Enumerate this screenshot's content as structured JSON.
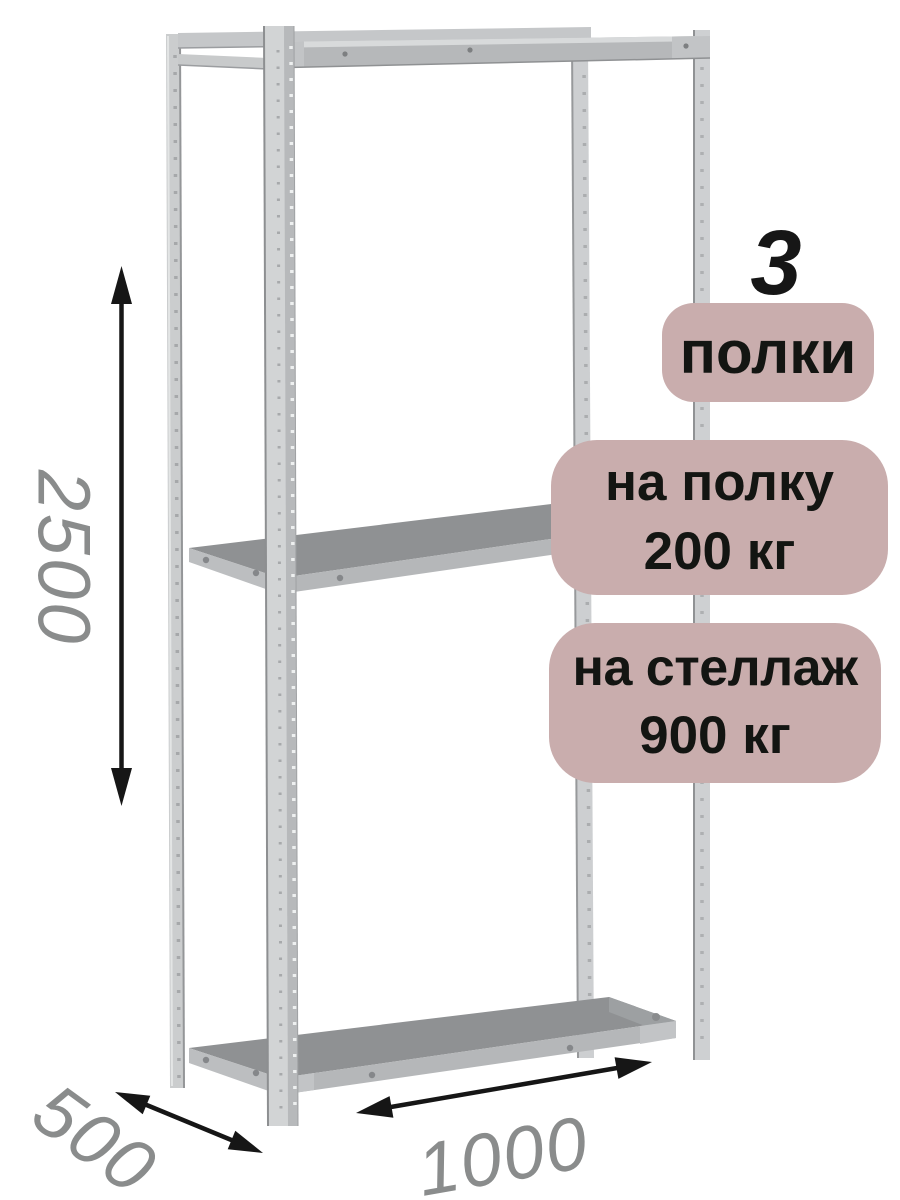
{
  "illustration": {
    "subject": "metal-shelving-rack",
    "shelves_shown": 3
  },
  "badges": {
    "shelves_count": "3",
    "shelves_label": "полки",
    "per_shelf_line1": "на полку",
    "per_shelf_line2": "200 кг",
    "per_rack_line1": "на стеллаж",
    "per_rack_line2": "900 кг"
  },
  "dimensions": {
    "height": "2500",
    "depth": "500",
    "width": "1000"
  },
  "colors": {
    "background": "#ffffff",
    "badge_bg": "#c9adad",
    "badge_text": "#131512",
    "dimension_text": "#8a8c8c",
    "arrow": "#161616",
    "metal_light": "#d2d4d5",
    "metal_mid": "#b5b7b9",
    "shelf_top": "#8f9193"
  }
}
